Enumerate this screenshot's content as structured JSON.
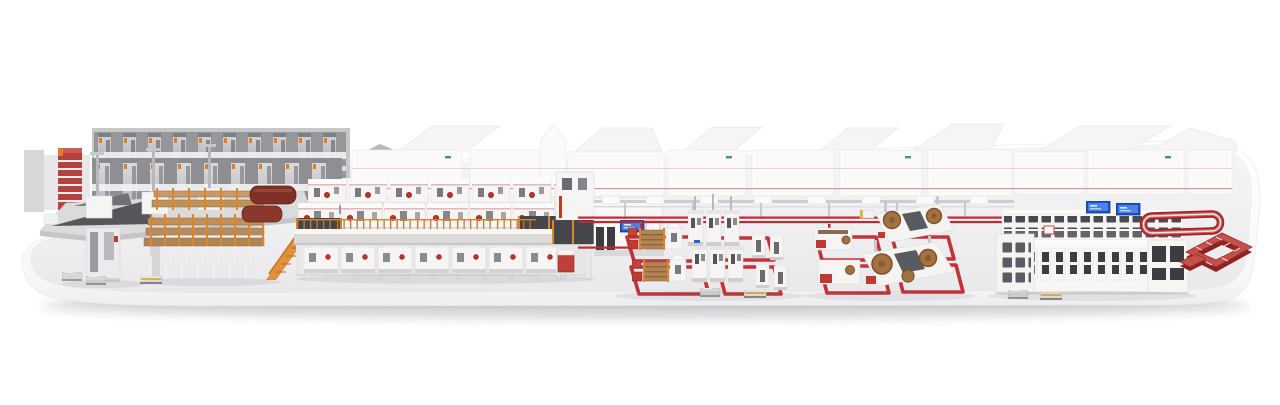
{
  "scene": {
    "type": "3d-product-render",
    "description": "Isometric 3D rendering of a complete corrugated board production plant presented on a rounded white display platform: roll storage racks, splicer infeed platform, corrugator line on an orange-railed mezzanine, dry end wall, overhead board conveyor, converting machine groups inside red floor conveyor track loops, a palletizing and logistics line with blue control screens, a red racetrack conveyor and a red shipping conveyor loop, with small automated guided vehicles on the floor.",
    "background_color": "#ffffff"
  },
  "platform": {
    "label": "display platform",
    "top_color": "#f0f0f2",
    "side_color": "#fbfbfc",
    "shadow_color": "rgba(110,110,122,0.30)"
  },
  "palette": {
    "accent_red": "#c0392b",
    "track_red": "#c2282e",
    "dark_red": "#8e2322",
    "maroon_roll": "#7c3026",
    "scaffold_orange": "#d8862f",
    "board_brown": "#b08455",
    "roll_brown": "#a4713f",
    "machine_white": "#f6f5f4",
    "panel_dark": "#45464a",
    "steel_gray": "#c9c9cc",
    "rack_gray": "#97979b",
    "screen_blue": "#2a5fd6",
    "agv_yellow": "#e2b63c",
    "logo_green": "#3f9b6e"
  },
  "sections": [
    {
      "id": "roll-storage-racks",
      "label": "Roll storage racks"
    },
    {
      "id": "red-stripe-tower",
      "label": "Striped service tower"
    },
    {
      "id": "splicer-platform",
      "label": "Splicer infeed platform"
    },
    {
      "id": "bridge-board-storage",
      "label": "Bridge with board storage and stairs"
    },
    {
      "id": "corrugator-line",
      "label": "Corrugator line on mezzanine"
    },
    {
      "id": "dry-end",
      "label": "Dry end unit and wall"
    },
    {
      "id": "overhead-conveyor",
      "label": "Overhead board conveyor"
    },
    {
      "id": "floor-tracks",
      "label": "Red floor conveyor tracks"
    },
    {
      "id": "converting-area-1",
      "label": "Converting machines group 1"
    },
    {
      "id": "converting-area-2",
      "label": "Converting machines group 2 with paper rolls"
    },
    {
      "id": "logistics-line",
      "label": "Palletizing and logistics line"
    },
    {
      "id": "conveyor-racetrack",
      "label": "Racetrack conveyor loop"
    },
    {
      "id": "shipping-loop",
      "label": "Shipping conveyor loop"
    },
    {
      "id": "agvs",
      "label": "Automated guided vehicles"
    }
  ],
  "screens": {
    "color": "#2a5fd6",
    "count": 4
  }
}
